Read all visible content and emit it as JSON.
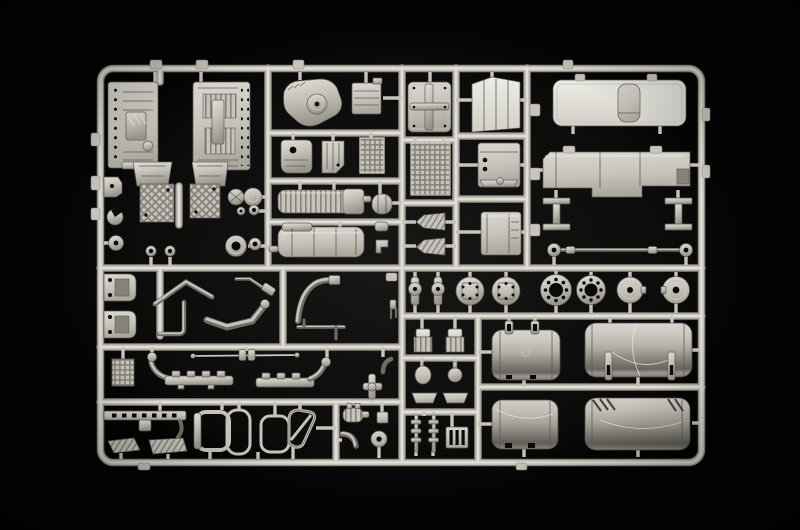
{
  "scene": {
    "alt": "Photograph of a light grey injection-moulded model kit sprue (parts tree) for a truck model, laid on a black background. The rectangular runner frame holds engine halves, cab panels, a roof with sunroof, wheel hubs and brake discs, four cylindrical fuel tanks, exhaust pipes, manifolds, window frames and many small fittings.",
    "background_color": "#030303",
    "css_vars": "--run-edge:#8e8b82;--run-mid:#c7c4bb;--run-hi:#eae8e1;--edge:#5d5b55;--hole:#0a0a08;--metal:#c6c3ba;--metal-dk:#858279;--tube:#6e6c64",
    "palette": {
      "plastic_highlight": "#eae8e1",
      "plastic_base": "#c6c3ba",
      "plastic_shadow": "#858279",
      "deep_shadow": "#504f49",
      "hole_dark": "#0a0a08"
    }
  },
  "sprue": {
    "material": "light grey polystyrene",
    "regions": {
      "top_left_engine_bay": {
        "parts": [
          "engine block half (left)",
          "engine block half (right)",
          "flywheel housing x2",
          "quilted sump plate x2",
          "belt pulley pair",
          "grooved idler pulley",
          "towing eyelet x2",
          "mount bracket",
          "cap disc"
        ]
      },
      "top_middle_drivetrain": {
        "parts": [
          "clutch housing",
          "battery box",
          "oil pan",
          "side panel",
          "radiator core",
          "finned intercooler",
          "air reservoir",
          "muffler tank",
          "small valve x2"
        ]
      },
      "top_center_cab": {
        "parts": [
          "riveted cab rear panel",
          "treadplate panel",
          "mud flap x2",
          "roof air deflector",
          "engine cylinder block",
          "storage box"
        ]
      },
      "top_right_cab": {
        "parts": [
          "cab roof panel with sunroof",
          "cab floor panel",
          "chassis crossmember x2",
          "steering tie rod"
        ]
      },
      "middle_right_axle": {
        "parts": [
          "steering knuckle x2",
          "wheel hub x2",
          "drilled brake disc x2",
          "hub cap x2"
        ]
      },
      "bottom_left_chassis": {
        "parts": [
          "cab mount bracket x2",
          "header pipe",
          "coolant pipe",
          "exhaust flex downpipe",
          "air intake elbow",
          "heater pipe",
          "quilted plate",
          "exhaust manifold x2",
          "linkage rod",
          "junction cross",
          "slotted side rail",
          "step plate x2",
          "door window frame x2",
          "window glass frame",
          "vent window frame",
          "finned silencer",
          "elbow pipe",
          "belt pulley"
        ]
      },
      "bottom_right_tanks": {
        "parts": [
          "air compressor x2",
          "mirror head",
          "ball fitting",
          "visor bracket x2",
          "lamp stalk x2",
          "step grille",
          "fuel tank with strap buckles x2",
          "fuel tank x2"
        ]
      }
    }
  }
}
